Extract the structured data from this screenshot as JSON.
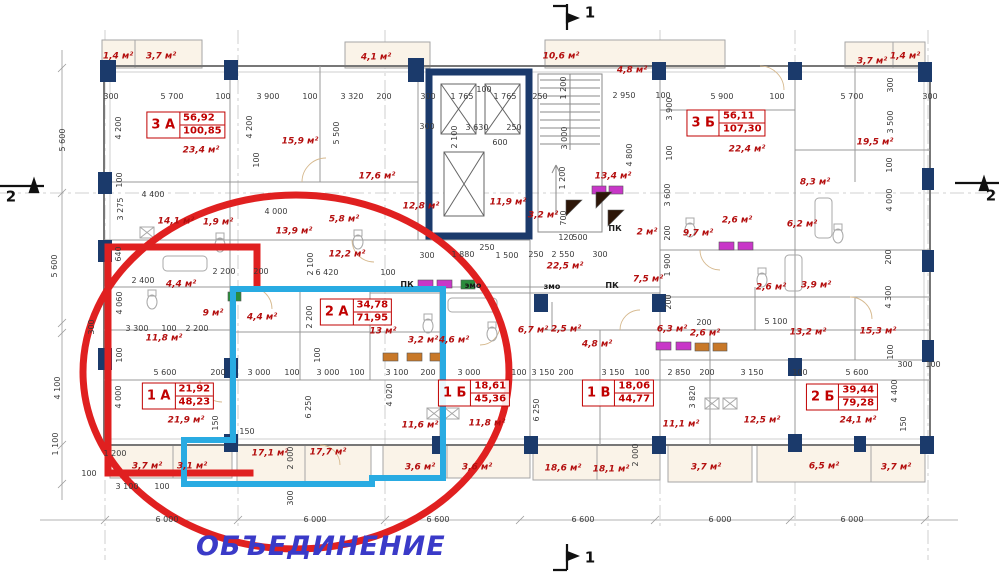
{
  "note": {
    "text": "ОБЪЕДИНЕНИЕ",
    "color": "#3a3ac8"
  },
  "overlays": {
    "ellipse_color": "#e02020",
    "unit_red_color": "#e02020",
    "unit_cyan_color": "#29abe2"
  },
  "section_markers": [
    {
      "label": "1",
      "x": 590,
      "y": 13
    },
    {
      "label": "1",
      "x": 590,
      "y": 558
    },
    {
      "label": "2",
      "x": 11,
      "y": 197
    },
    {
      "label": "2",
      "x": 991,
      "y": 196
    }
  ],
  "apartments": [
    {
      "code": "3 А",
      "area_living": "56,92",
      "area_total": "100,85",
      "x": 186,
      "y": 125
    },
    {
      "code": "3 Б",
      "area_living": "56,11",
      "area_total": "107,30",
      "x": 726,
      "y": 123
    },
    {
      "code": "2 А",
      "area_living": "34,78",
      "area_total": "71,95",
      "x": 356,
      "y": 312
    },
    {
      "code": "1 А",
      "area_living": "21,92",
      "area_total": "48,23",
      "x": 178,
      "y": 396
    },
    {
      "code": "1 Б",
      "area_living": "18,61",
      "area_total": "45,36",
      "x": 474,
      "y": 393
    },
    {
      "code": "1 В",
      "area_living": "18,06",
      "area_total": "44,77",
      "x": 618,
      "y": 393
    },
    {
      "code": "2 Б",
      "area_living": "39,44",
      "area_total": "79,28",
      "x": 842,
      "y": 397
    }
  ],
  "room_labels": [
    {
      "t": "1,4 м²",
      "x": 118,
      "y": 57
    },
    {
      "t": "3,7 м²",
      "x": 161,
      "y": 57
    },
    {
      "t": "4,1 м²",
      "x": 376,
      "y": 58
    },
    {
      "t": "10,6 м²",
      "x": 561,
      "y": 57
    },
    {
      "t": "4,8 м²",
      "x": 632,
      "y": 71
    },
    {
      "t": "3,7 м²",
      "x": 872,
      "y": 62
    },
    {
      "t": "1,4 м²",
      "x": 905,
      "y": 57
    },
    {
      "t": "23,4 м²",
      "x": 201,
      "y": 151
    },
    {
      "t": "15,9 м²",
      "x": 300,
      "y": 142
    },
    {
      "t": "17,6 м²",
      "x": 377,
      "y": 177
    },
    {
      "t": "14,1 м²",
      "x": 176,
      "y": 222
    },
    {
      "t": "1,9 м²",
      "x": 218,
      "y": 223
    },
    {
      "t": "13,9 м²",
      "x": 294,
      "y": 232
    },
    {
      "t": "5,8 м²",
      "x": 344,
      "y": 220
    },
    {
      "t": "12,2 м²",
      "x": 347,
      "y": 255
    },
    {
      "t": "12,8 м²",
      "x": 421,
      "y": 207
    },
    {
      "t": "11,9 м²",
      "x": 508,
      "y": 203
    },
    {
      "t": "3,2 м²",
      "x": 543,
      "y": 216
    },
    {
      "t": "13,4 м²",
      "x": 613,
      "y": 177
    },
    {
      "t": "22,5 м²",
      "x": 565,
      "y": 267
    },
    {
      "t": "2 м²",
      "x": 647,
      "y": 233
    },
    {
      "t": "9,7 м²",
      "x": 698,
      "y": 234
    },
    {
      "t": "2,6 м²",
      "x": 737,
      "y": 221
    },
    {
      "t": "6,2 м²",
      "x": 802,
      "y": 225
    },
    {
      "t": "8,3 м²",
      "x": 815,
      "y": 183
    },
    {
      "t": "22,4 м²",
      "x": 747,
      "y": 150
    },
    {
      "t": "19,5 м²",
      "x": 875,
      "y": 143
    },
    {
      "t": "7,5 м²",
      "x": 648,
      "y": 280
    },
    {
      "t": "2,6 м²",
      "x": 771,
      "y": 288
    },
    {
      "t": "3,9 м²",
      "x": 816,
      "y": 286
    },
    {
      "t": "6,3 м²",
      "x": 672,
      "y": 330
    },
    {
      "t": "2,6 м²",
      "x": 705,
      "y": 334
    },
    {
      "t": "13,2 м²",
      "x": 808,
      "y": 333
    },
    {
      "t": "15,3 м²",
      "x": 878,
      "y": 332
    },
    {
      "t": "4,4 м²",
      "x": 181,
      "y": 285
    },
    {
      "t": "9 м²",
      "x": 213,
      "y": 314
    },
    {
      "t": "11,8 м²",
      "x": 164,
      "y": 339
    },
    {
      "t": "4,4 м²",
      "x": 262,
      "y": 318
    },
    {
      "t": "13 м²",
      "x": 383,
      "y": 332
    },
    {
      "t": "3,2 м²",
      "x": 423,
      "y": 341
    },
    {
      "t": "4,6 м²",
      "x": 454,
      "y": 341
    },
    {
      "t": "6,7 м²",
      "x": 533,
      "y": 331
    },
    {
      "t": "2,5 м²",
      "x": 566,
      "y": 330
    },
    {
      "t": "4,8 м²",
      "x": 597,
      "y": 345
    },
    {
      "t": "21,9 м²",
      "x": 186,
      "y": 421
    },
    {
      "t": "3,7 м²",
      "x": 147,
      "y": 467
    },
    {
      "t": "3,1 м²",
      "x": 192,
      "y": 467
    },
    {
      "t": "17,1 м²",
      "x": 270,
      "y": 454
    },
    {
      "t": "17,7 м²",
      "x": 328,
      "y": 453
    },
    {
      "t": "11,6 м²",
      "x": 420,
      "y": 426
    },
    {
      "t": "11,8 м²",
      "x": 487,
      "y": 424
    },
    {
      "t": "3,6 м²",
      "x": 420,
      "y": 468
    },
    {
      "t": "3,6 м²",
      "x": 477,
      "y": 468
    },
    {
      "t": "18,6 м²",
      "x": 563,
      "y": 469
    },
    {
      "t": "18,1 м²",
      "x": 611,
      "y": 470
    },
    {
      "t": "11,1 м²",
      "x": 681,
      "y": 425
    },
    {
      "t": "12,5 м²",
      "x": 762,
      "y": 421
    },
    {
      "t": "24,1 м²",
      "x": 858,
      "y": 421
    },
    {
      "t": "3,7 м²",
      "x": 706,
      "y": 468
    },
    {
      "t": "6,5 м²",
      "x": 824,
      "y": 467
    },
    {
      "t": "3,7 м²",
      "x": 896,
      "y": 468
    }
  ],
  "tech_labels": [
    {
      "t": "ПК",
      "x": 407,
      "y": 285
    },
    {
      "t": "ПК",
      "x": 615,
      "y": 229
    },
    {
      "t": "ПК",
      "x": 612,
      "y": 286
    },
    {
      "t": "эмо",
      "x": 473,
      "y": 286
    },
    {
      "t": "змо",
      "x": 552,
      "y": 287
    }
  ],
  "dims_h": [
    {
      "t": "300",
      "x": 111,
      "y": 97
    },
    {
      "t": "5 700",
      "x": 172,
      "y": 97
    },
    {
      "t": "100",
      "x": 223,
      "y": 97
    },
    {
      "t": "3 900",
      "x": 268,
      "y": 97
    },
    {
      "t": "100",
      "x": 310,
      "y": 97
    },
    {
      "t": "3 320",
      "x": 352,
      "y": 97
    },
    {
      "t": "200",
      "x": 384,
      "y": 97
    },
    {
      "t": "300",
      "x": 428,
      "y": 97
    },
    {
      "t": "1 765",
      "x": 462,
      "y": 97
    },
    {
      "t": "100",
      "x": 484,
      "y": 90
    },
    {
      "t": "1 765",
      "x": 505,
      "y": 97
    },
    {
      "t": "250",
      "x": 540,
      "y": 97
    },
    {
      "t": "2 950",
      "x": 624,
      "y": 96
    },
    {
      "t": "100",
      "x": 663,
      "y": 96
    },
    {
      "t": "5 900",
      "x": 722,
      "y": 97
    },
    {
      "t": "100",
      "x": 777,
      "y": 97
    },
    {
      "t": "5 700",
      "x": 852,
      "y": 97
    },
    {
      "t": "300",
      "x": 930,
      "y": 97
    },
    {
      "t": "4 400",
      "x": 153,
      "y": 195
    },
    {
      "t": "300",
      "x": 427,
      "y": 127
    },
    {
      "t": "3 630",
      "x": 477,
      "y": 128
    },
    {
      "t": "250",
      "x": 514,
      "y": 128
    },
    {
      "t": "600",
      "x": 500,
      "y": 143
    },
    {
      "t": "120",
      "x": 566,
      "y": 238
    },
    {
      "t": "500",
      "x": 580,
      "y": 238
    },
    {
      "t": "4 000",
      "x": 276,
      "y": 212
    },
    {
      "t": "2 200",
      "x": 224,
      "y": 272
    },
    {
      "t": "200",
      "x": 261,
      "y": 272
    },
    {
      "t": "6 420",
      "x": 327,
      "y": 273
    },
    {
      "t": "100",
      "x": 388,
      "y": 273
    },
    {
      "t": "2 400",
      "x": 143,
      "y": 281
    },
    {
      "t": "3 300",
      "x": 137,
      "y": 329
    },
    {
      "t": "100",
      "x": 169,
      "y": 329
    },
    {
      "t": "2 200",
      "x": 197,
      "y": 329
    },
    {
      "t": "300",
      "x": 427,
      "y": 256
    },
    {
      "t": "1 880",
      "x": 463,
      "y": 255
    },
    {
      "t": "250",
      "x": 487,
      "y": 248
    },
    {
      "t": "1 500",
      "x": 507,
      "y": 256
    },
    {
      "t": "250",
      "x": 536,
      "y": 255
    },
    {
      "t": "2 550",
      "x": 563,
      "y": 255
    },
    {
      "t": "300",
      "x": 600,
      "y": 255
    },
    {
      "t": "200",
      "x": 704,
      "y": 323
    },
    {
      "t": "5 100",
      "x": 776,
      "y": 322
    },
    {
      "t": "300",
      "x": 905,
      "y": 365
    },
    {
      "t": "100",
      "x": 933,
      "y": 365
    },
    {
      "t": "5 600",
      "x": 165,
      "y": 373
    },
    {
      "t": "200",
      "x": 218,
      "y": 373
    },
    {
      "t": "3 000",
      "x": 259,
      "y": 373
    },
    {
      "t": "100",
      "x": 292,
      "y": 373
    },
    {
      "t": "3 000",
      "x": 328,
      "y": 373
    },
    {
      "t": "100",
      "x": 357,
      "y": 373
    },
    {
      "t": "3 100",
      "x": 397,
      "y": 373
    },
    {
      "t": "200",
      "x": 428,
      "y": 373
    },
    {
      "t": "3 000",
      "x": 469,
      "y": 373
    },
    {
      "t": "100",
      "x": 519,
      "y": 373
    },
    {
      "t": "3 150",
      "x": 543,
      "y": 373
    },
    {
      "t": "200",
      "x": 566,
      "y": 373
    },
    {
      "t": "3 150",
      "x": 613,
      "y": 373
    },
    {
      "t": "100",
      "x": 642,
      "y": 373
    },
    {
      "t": "2 850",
      "x": 679,
      "y": 373
    },
    {
      "t": "200",
      "x": 707,
      "y": 373
    },
    {
      "t": "3 150",
      "x": 752,
      "y": 373
    },
    {
      "t": "100",
      "x": 800,
      "y": 373
    },
    {
      "t": "5 600",
      "x": 857,
      "y": 373
    },
    {
      "t": "1 200",
      "x": 115,
      "y": 454
    },
    {
      "t": "3 100",
      "x": 127,
      "y": 487
    },
    {
      "t": "100",
      "x": 162,
      "y": 487
    },
    {
      "t": "150",
      "x": 247,
      "y": 432
    },
    {
      "t": "100",
      "x": 89,
      "y": 474
    },
    {
      "t": "6 000",
      "x": 167,
      "y": 520
    },
    {
      "t": "6 000",
      "x": 315,
      "y": 520
    },
    {
      "t": "6 600",
      "x": 438,
      "y": 520
    },
    {
      "t": "6 600",
      "x": 583,
      "y": 520
    },
    {
      "t": "6 000",
      "x": 720,
      "y": 520
    },
    {
      "t": "6 000",
      "x": 852,
      "y": 520
    }
  ],
  "dims_v": [
    {
      "t": "5 600",
      "x": 63,
      "y": 140
    },
    {
      "t": "5 600",
      "x": 55,
      "y": 266
    },
    {
      "t": "300",
      "x": 92,
      "y": 327
    },
    {
      "t": "4 100",
      "x": 58,
      "y": 388
    },
    {
      "t": "1 100",
      "x": 56,
      "y": 444
    },
    {
      "t": "4 200",
      "x": 119,
      "y": 128
    },
    {
      "t": "100",
      "x": 120,
      "y": 180
    },
    {
      "t": "3 275",
      "x": 121,
      "y": 209
    },
    {
      "t": "640",
      "x": 119,
      "y": 254
    },
    {
      "t": "4 060",
      "x": 120,
      "y": 303
    },
    {
      "t": "100",
      "x": 120,
      "y": 355
    },
    {
      "t": "4 000",
      "x": 119,
      "y": 397
    },
    {
      "t": "4 200",
      "x": 250,
      "y": 127
    },
    {
      "t": "100",
      "x": 257,
      "y": 160
    },
    {
      "t": "5 500",
      "x": 337,
      "y": 133
    },
    {
      "t": "2 100",
      "x": 455,
      "y": 137
    },
    {
      "t": "1 200",
      "x": 564,
      "y": 88
    },
    {
      "t": "3 000",
      "x": 565,
      "y": 138
    },
    {
      "t": "1 200",
      "x": 563,
      "y": 178
    },
    {
      "t": "700",
      "x": 564,
      "y": 218
    },
    {
      "t": "2 100",
      "x": 311,
      "y": 264
    },
    {
      "t": "2 200",
      "x": 310,
      "y": 317
    },
    {
      "t": "100",
      "x": 318,
      "y": 355
    },
    {
      "t": "3 900",
      "x": 670,
      "y": 109
    },
    {
      "t": "100",
      "x": 670,
      "y": 153
    },
    {
      "t": "3 600",
      "x": 668,
      "y": 195
    },
    {
      "t": "200",
      "x": 668,
      "y": 233
    },
    {
      "t": "4 800",
      "x": 630,
      "y": 155
    },
    {
      "t": "1 900",
      "x": 668,
      "y": 265
    },
    {
      "t": "200",
      "x": 669,
      "y": 302
    },
    {
      "t": "300",
      "x": 891,
      "y": 85
    },
    {
      "t": "3 500",
      "x": 891,
      "y": 122
    },
    {
      "t": "100",
      "x": 890,
      "y": 165
    },
    {
      "t": "4 000",
      "x": 890,
      "y": 200
    },
    {
      "t": "200",
      "x": 889,
      "y": 257
    },
    {
      "t": "4 300",
      "x": 889,
      "y": 297
    },
    {
      "t": "100",
      "x": 891,
      "y": 352
    },
    {
      "t": "4 400",
      "x": 895,
      "y": 391
    },
    {
      "t": "150",
      "x": 904,
      "y": 424
    },
    {
      "t": "6 250",
      "x": 309,
      "y": 407
    },
    {
      "t": "2 000",
      "x": 291,
      "y": 458
    },
    {
      "t": "300",
      "x": 291,
      "y": 498
    },
    {
      "t": "150",
      "x": 216,
      "y": 423
    },
    {
      "t": "4 020",
      "x": 390,
      "y": 395
    },
    {
      "t": "6 250",
      "x": 537,
      "y": 410
    },
    {
      "t": "2 000",
      "x": 636,
      "y": 455
    },
    {
      "t": "3 820",
      "x": 693,
      "y": 397
    }
  ]
}
